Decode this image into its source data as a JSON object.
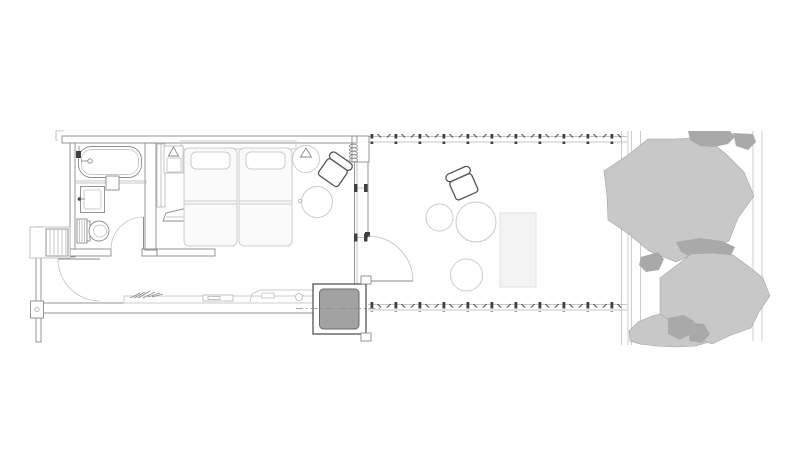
{
  "document": {
    "type": "architectural-floor-plan",
    "view": "top-down plan of a guest room with deck and garden",
    "visible_text": "none"
  },
  "colors": {
    "line-dark": "#555555",
    "line-mid": "#8a8a8a",
    "line-light": "#b5b5b5",
    "furniture-line": "#cccccc",
    "furniture-fill": "#fafafa",
    "hatch": "#b4b4b4",
    "dot": "#c2c2c2",
    "post": "#3f3f3f",
    "fence": "#cccccc",
    "tree-light": "#c8c8c8",
    "tree-dark": "#a9a9a9",
    "tree-edge": "#a5a5a5",
    "tub-fill": "#a2a2a2",
    "tub-edge": "#6b6b6b",
    "lounger-fill": "#f3f3f3",
    "lounger-line": "#e0e0e0",
    "swing-line": "#c0c0c0"
  },
  "plan": {
    "rooms": [
      {
        "id": "bathroom",
        "fixtures": [
          "bathtub",
          "faucet",
          "wall-niche",
          "vanity-sink",
          "toilet",
          "door-swing"
        ]
      },
      {
        "id": "bedroom",
        "furniture": [
          "headboard-panel",
          "nightstand",
          "table-lamp",
          "step-wedge",
          "twin-bed-1",
          "twin-bed-2",
          "floor-lamp",
          "armchair",
          "round-side-table",
          "low-counter",
          "plant-sprig",
          "tray",
          "bench-step"
        ]
      },
      {
        "id": "entry-corridor",
        "features": [
          "entry-door-swing",
          "louvered-cabinet",
          "wall-post-box"
        ]
      },
      {
        "id": "deck-terrace",
        "furniture": [
          "deck-door-swing",
          "armchair",
          "round-table-small",
          "round-table-large",
          "round-stool",
          "lounger-mat",
          "soaking-tub"
        ],
        "features": [
          "railing-top",
          "railing-bottom",
          "glass-wall-mullions"
        ]
      },
      {
        "id": "garden",
        "features": [
          "fence-lines",
          "tree-canopy-top",
          "tree-canopy-bottom",
          "shrub-bottom",
          "dark-foliage-patches"
        ]
      }
    ],
    "railing": {
      "post_spacing_px": 24,
      "post_count_top": 11,
      "post_count_bottom": 11
    },
    "soaking_tub": {
      "outer_px": [
        313,
        284,
        53,
        50
      ],
      "inner_px": [
        320,
        289,
        39,
        40
      ]
    }
  }
}
